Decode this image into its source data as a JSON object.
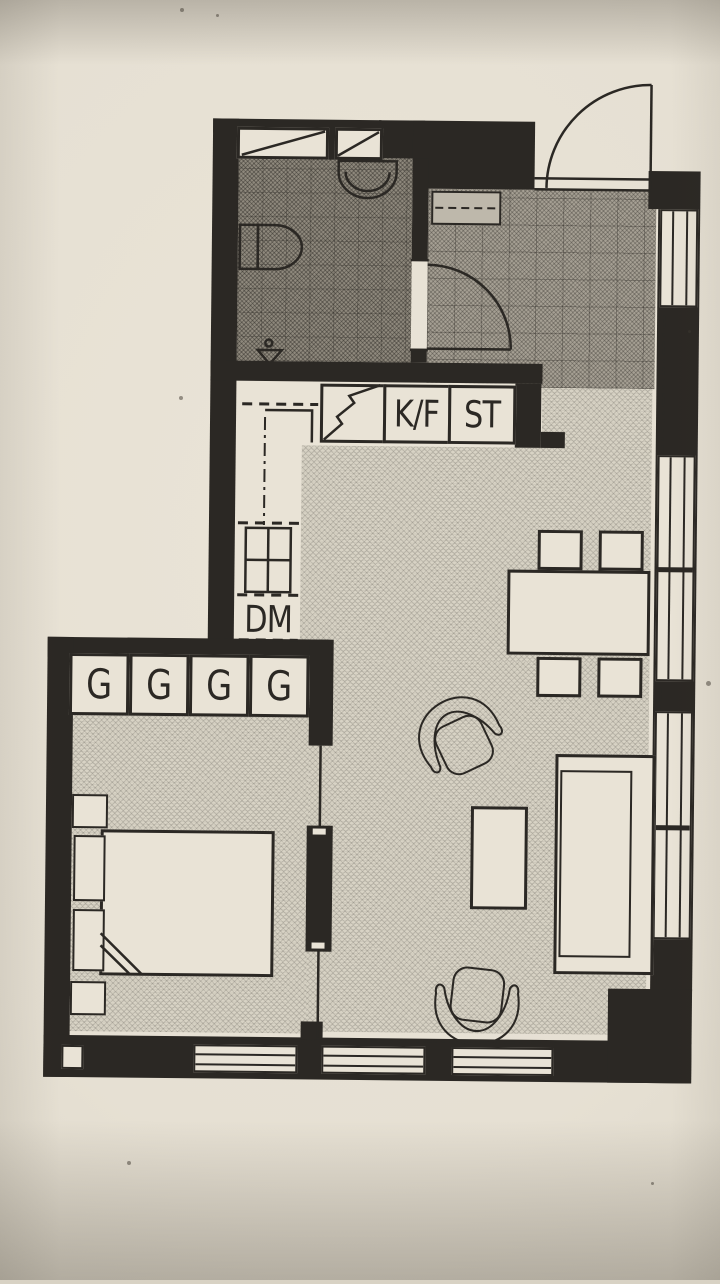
{
  "floorplan": {
    "kitchen": {
      "fridge_freezer_label": "K/F",
      "cleaning_cupboard_label": "ST",
      "dishwasher_label": "DM"
    },
    "bedroom": {
      "wardrobe_labels": [
        "G",
        "G",
        "G",
        "G"
      ]
    },
    "colors": {
      "ink": "#2b2824",
      "paper": "#e7e1d4",
      "floor_living": "#d8d3c5",
      "floor_hall": "#a59f93",
      "floor_bathroom": "#8e887c"
    }
  }
}
